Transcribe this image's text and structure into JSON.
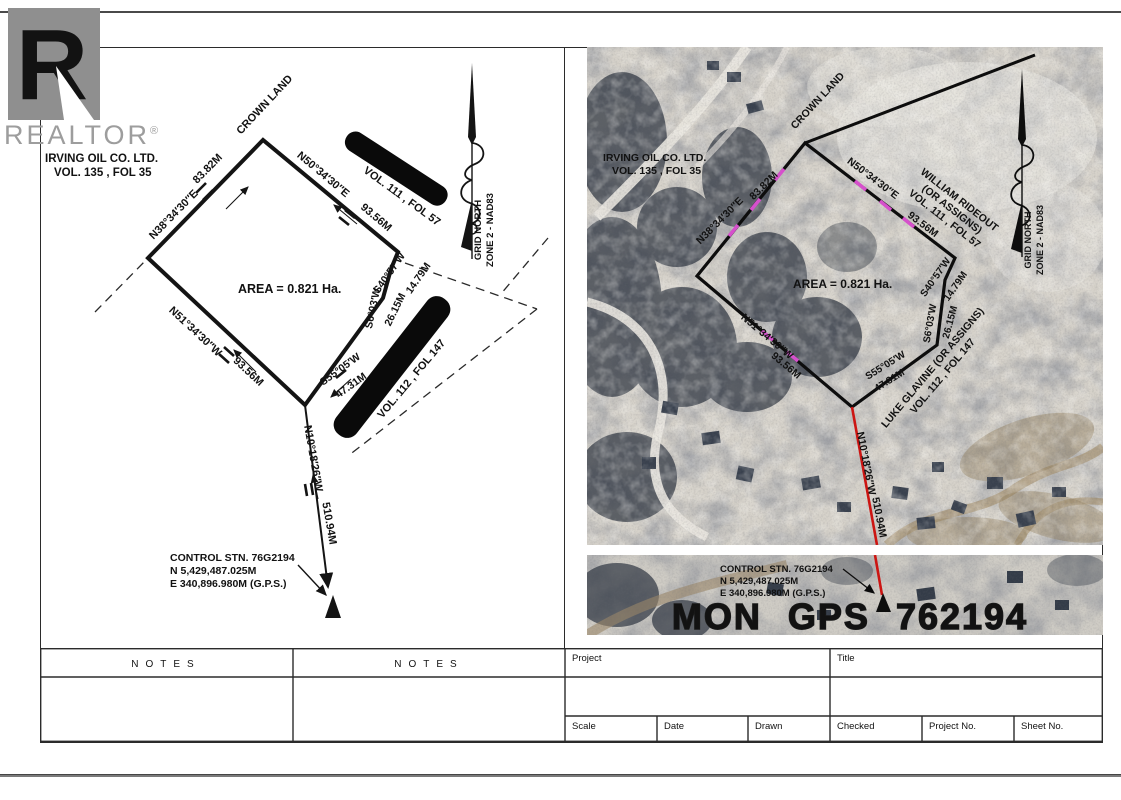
{
  "branding": {
    "logo_letter": "R",
    "wordmark": "REALTOR",
    "registered": "®"
  },
  "plan": {
    "owner_nw": {
      "line1": "IRVING OIL CO. LTD.",
      "line2": "VOL. 135 , FOL 35"
    },
    "crown_land": "CROWN LAND",
    "area": "AREA = 0.821 Ha.",
    "bearings": {
      "n38": "N38°34′30″E",
      "n38_dist": "83.82M",
      "n50": "N50°34′30″E",
      "n50_dist": "93.56M",
      "s40": "S40°57′W",
      "s40_dist": "14.79M",
      "s6": "S6°03′W",
      "s6_dist": "26.15M",
      "s55": "S55°05′W",
      "s55_dist": "47.31M",
      "n51": "N51°34′30″W",
      "n51_dist": "93.56M",
      "n10": "N10°18′26″W",
      "n10_dist": "510.94M"
    },
    "parcel_ne_vol": "VOL. 111 , FOL 57",
    "parcel_se_vol": "VOL. 112 , FOL 147",
    "north_arrow": {
      "line1": "GRID NORTH",
      "line2": "ZONE 2 - NAD83"
    },
    "control": {
      "line1": "CONTROL STN. 76G2194",
      "line2": "N 5,429,487.025M",
      "line3": "E 340,896.980M (G.P.S.)"
    }
  },
  "photo": {
    "parcel_ne_owner": {
      "line1": "WILLIAM RIDEOUT",
      "line2": "(OR ASSIGNS)",
      "line3": "VOL. 111 , FOL 57"
    },
    "parcel_se_owner": {
      "line1": "LUKE GLAVINE (OR ASSIGNS)",
      "line2": "VOL. 112 , FOL 147"
    },
    "monument_label": "MON GPS 762194"
  },
  "title_block": {
    "notes": "NOTES",
    "project": "Project",
    "title": "Title",
    "scale": "Scale",
    "date": "Date",
    "drawn": "Drawn",
    "checked": "Checked",
    "project_no": "Project No.",
    "sheet_no": "Sheet No."
  },
  "colors": {
    "boundary": "#141414",
    "pink_dash": "#d650cc",
    "red_tie": "#cc1512",
    "logo_gray": "#8f8f8f"
  }
}
